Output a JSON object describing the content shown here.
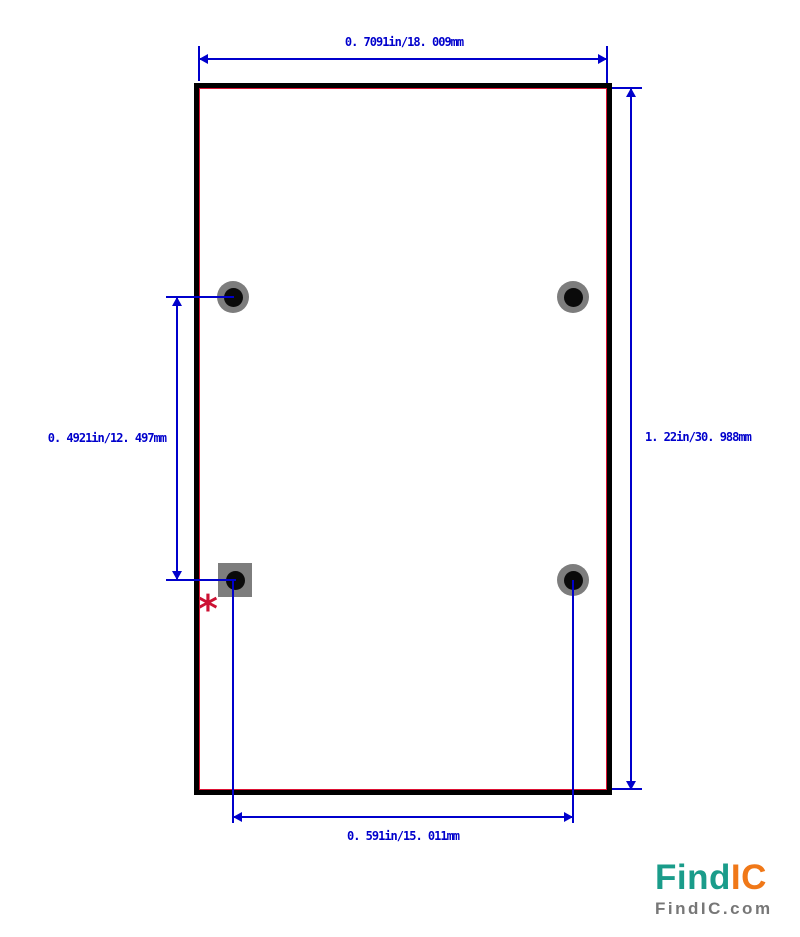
{
  "drawing": {
    "type": "component-footprint-dimension-drawing",
    "dimensions": {
      "top_width": "0. 7091in/18. 009mm",
      "right_height": "1. 22in/30. 988mm",
      "left_pad_pitch": "0. 4921in/12. 497mm",
      "bottom_pad_pitch": "0. 591in/15. 011mm"
    },
    "pin1_marker": "*",
    "pads": {
      "count": 4,
      "shapes": [
        "circle",
        "circle",
        "square",
        "circle"
      ]
    },
    "colors": {
      "dimension_blue": "#0000cc",
      "outline_black": "#000000",
      "silkscreen_red": "#dd1133",
      "pad_ring_gray": "#7d7d7d",
      "pad_hole_black": "#0a0a0a",
      "pin1_marker_red": "#cc1133"
    }
  },
  "logo": {
    "name_part1": "Find",
    "name_part2": "IC",
    "domain_text": "FindIC.com",
    "colors": {
      "teal": "#1a9c8a",
      "orange": "#f07818",
      "gray": "#777777"
    }
  }
}
